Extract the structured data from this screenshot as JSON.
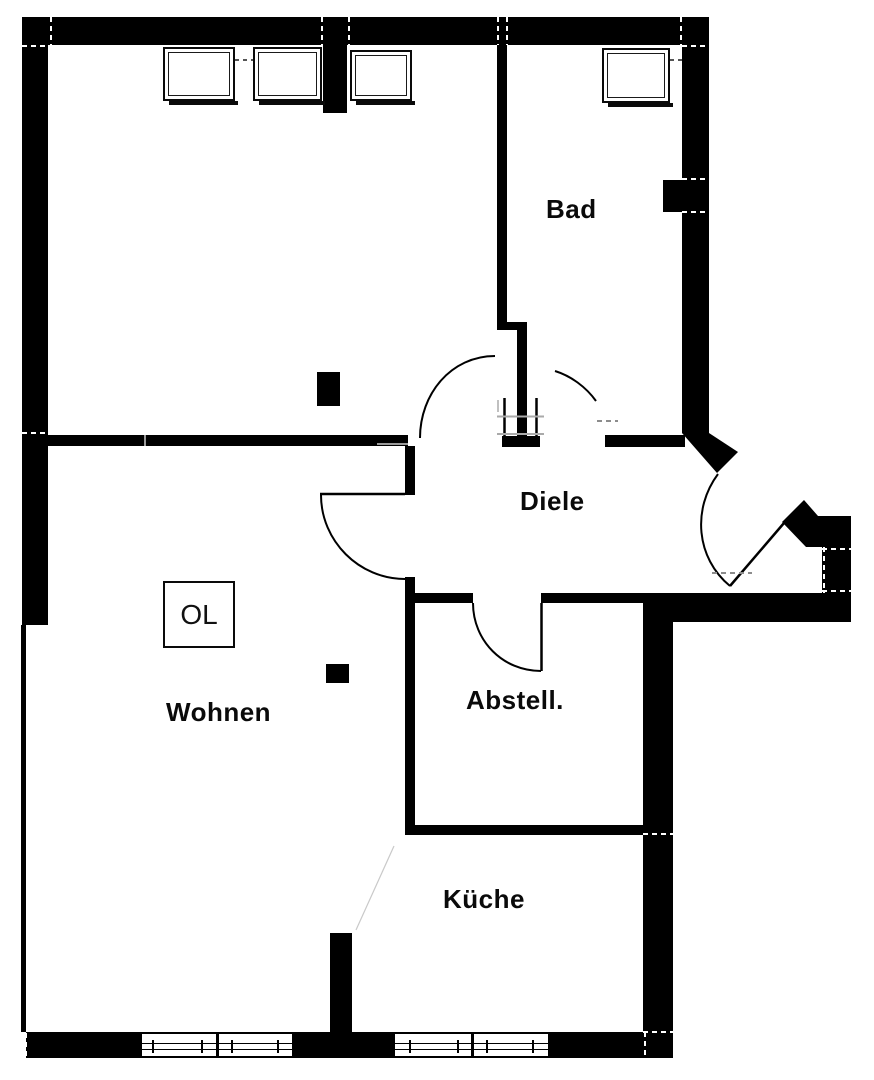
{
  "drawing_type": "apartment-floor-plan",
  "rooms": [
    {
      "id": "bad",
      "label": "Bad"
    },
    {
      "id": "diele",
      "label": "Diele"
    },
    {
      "id": "wohnen",
      "label": "Wohnen"
    },
    {
      "id": "abstell",
      "label": "Abstell."
    },
    {
      "id": "kueche",
      "label": "Küche"
    }
  ],
  "markers": {
    "skylight_label": "OL"
  },
  "colors": {
    "wall": "#000000",
    "background": "#ffffff",
    "tick": "#9a9a9a"
  }
}
